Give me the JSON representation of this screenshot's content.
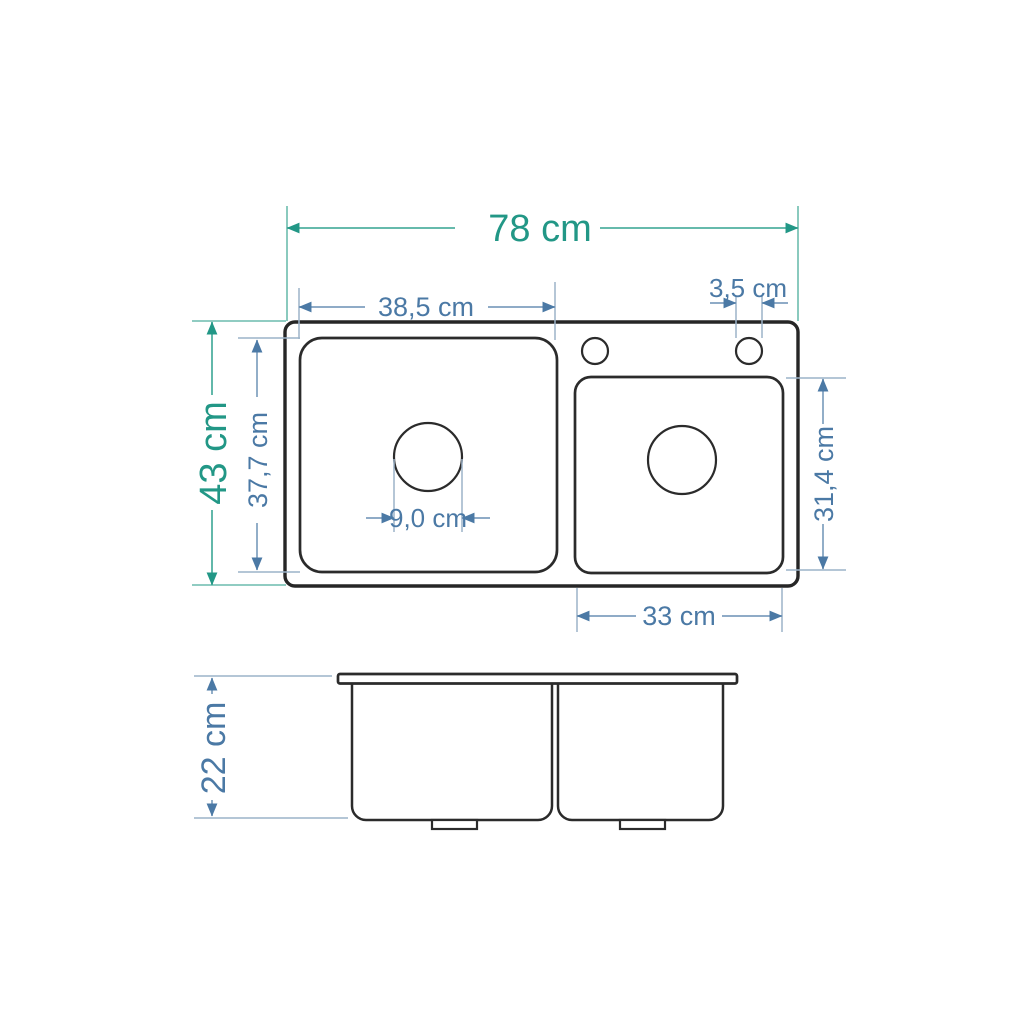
{
  "diagram": {
    "type": "technical-dimension-drawing",
    "subject": "double-bowl inset kitchen sink, top view and front view",
    "colors": {
      "background": "#ffffff",
      "drawing_outline": "#262626",
      "primary_dimension": "#229786",
      "secondary_dimension": "#4b79a5",
      "primary_dimension_line": "#6cbcae",
      "secondary_dimension_line": "#9cb3c9"
    },
    "dimensions": {
      "total_width": {
        "label": "78 cm",
        "value": 78,
        "unit": "cm"
      },
      "left_bowl_width": {
        "label": "38,5 cm",
        "value": 38.5,
        "unit": "cm"
      },
      "faucet_hole_diameter": {
        "label": "3,5 cm",
        "value": 3.5,
        "unit": "cm"
      },
      "total_depth": {
        "label": "43 cm",
        "value": 43,
        "unit": "cm"
      },
      "left_bowl_depth": {
        "label": "37,7 cm",
        "value": 37.7,
        "unit": "cm"
      },
      "drain_diameter": {
        "label": "9,0 cm",
        "value": 9.0,
        "unit": "cm"
      },
      "right_bowl_depth": {
        "label": "31,4 cm",
        "value": 31.4,
        "unit": "cm"
      },
      "right_bowl_width": {
        "label": "33 cm",
        "value": 33,
        "unit": "cm"
      },
      "sink_height": {
        "label": "22 cm",
        "value": 22,
        "unit": "cm"
      }
    }
  }
}
